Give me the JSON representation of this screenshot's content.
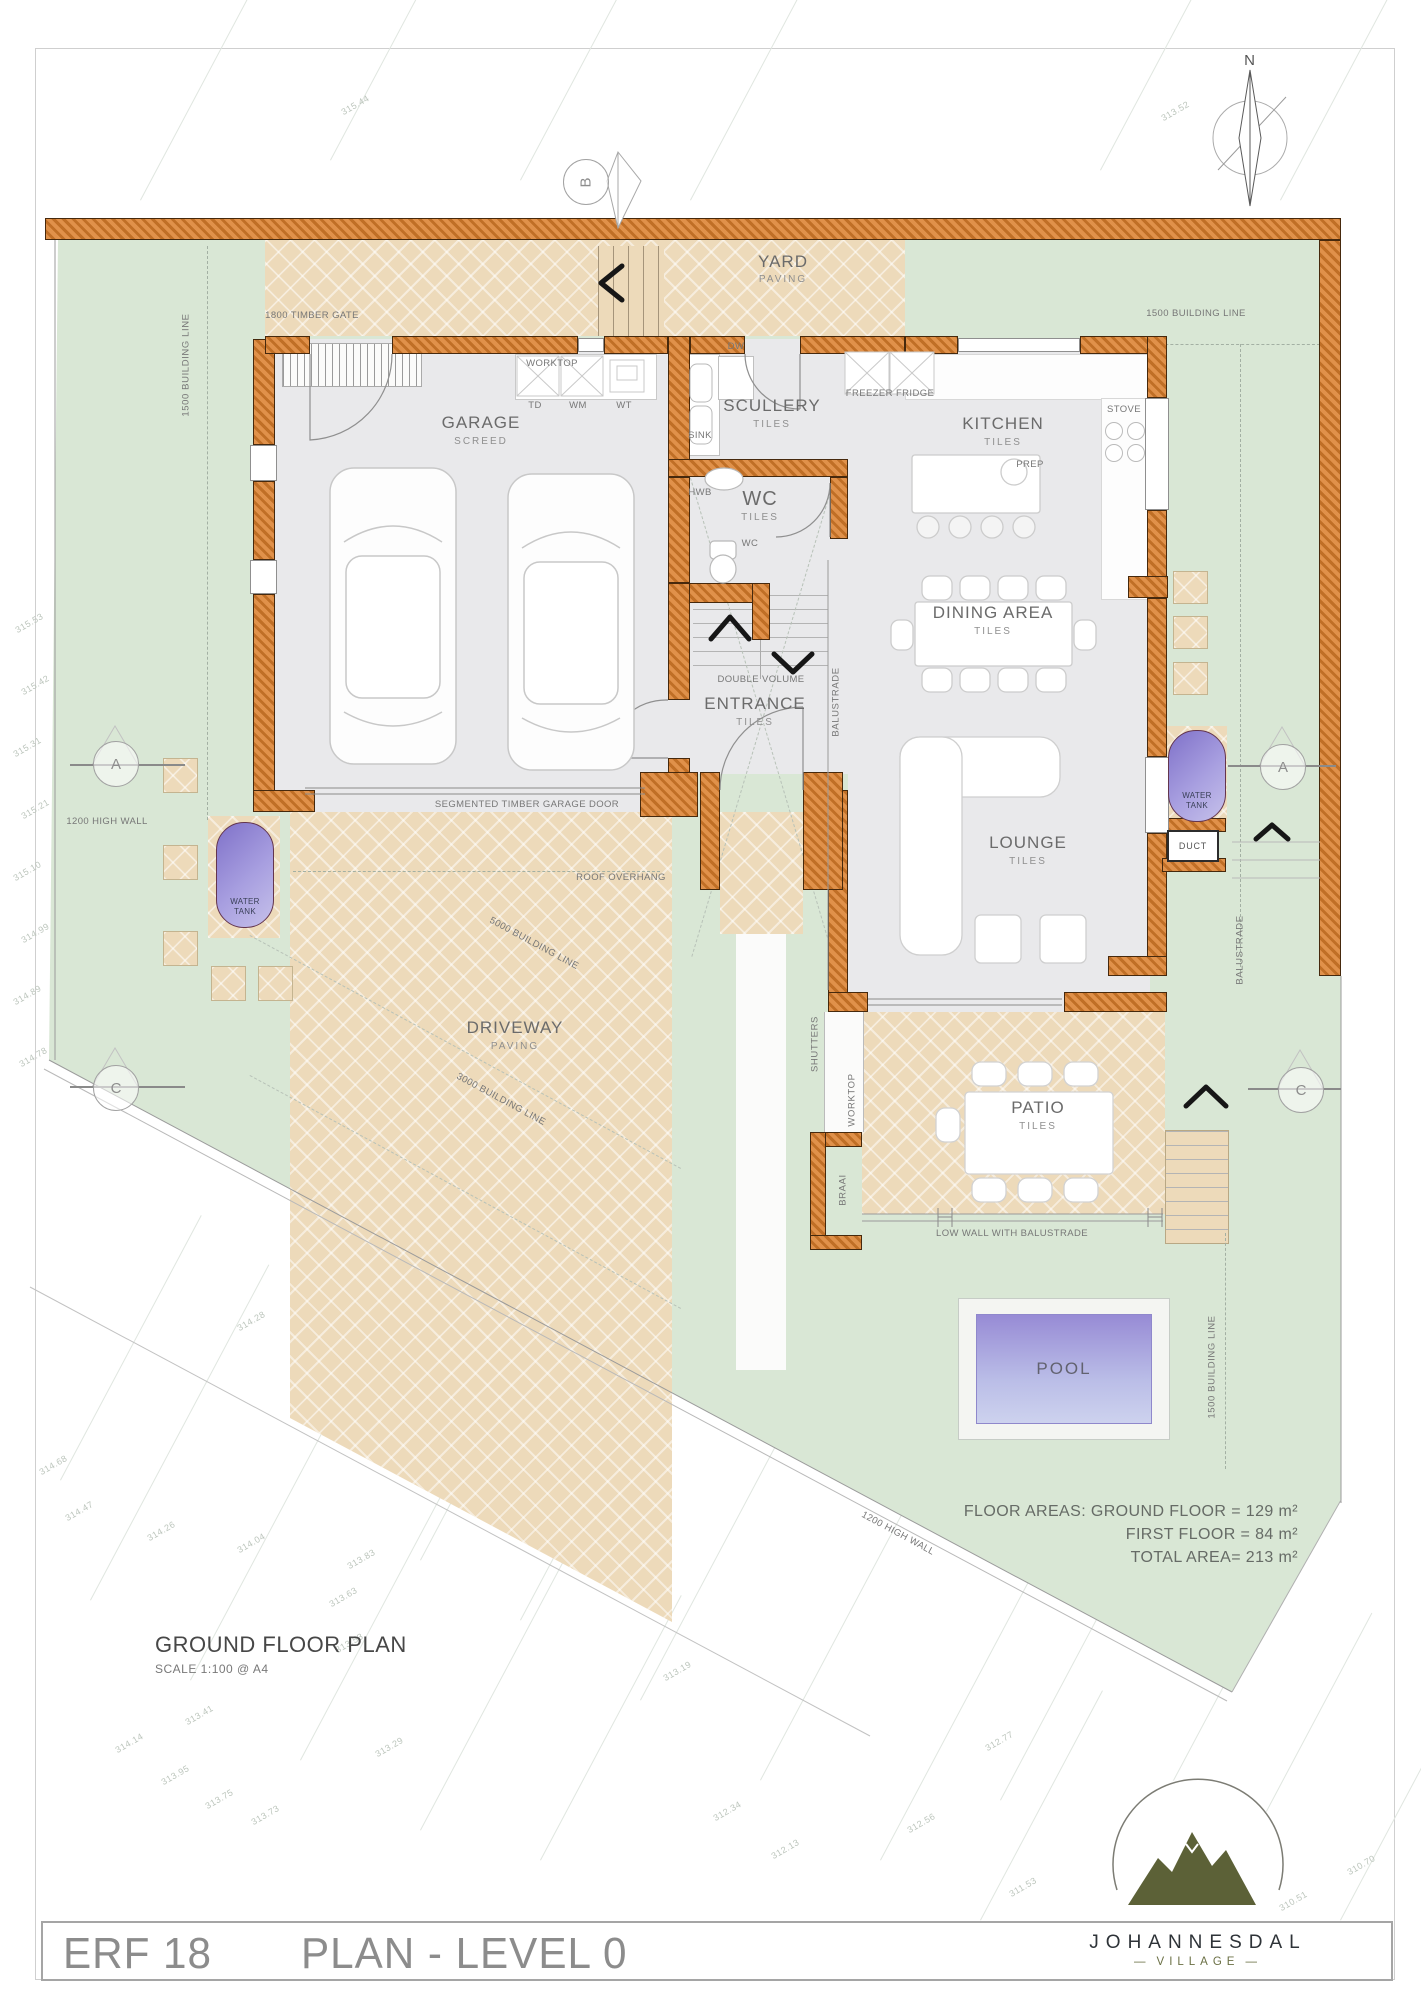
{
  "title_block": {
    "erf": "ERF 18",
    "plan_label": "PLAN - LEVEL 0"
  },
  "logo": {
    "name": "JOHANNESDAL",
    "subtitle": "VILLAGE"
  },
  "plan_heading": {
    "title": "GROUND FLOOR PLAN",
    "scale": "SCALE 1:100 @ A4"
  },
  "floor_areas": {
    "line1": "FLOOR AREAS: GROUND FLOOR = 129 m²",
    "line2": "FIRST FLOOR =   84 m²",
    "line3": "TOTAL AREA= 213 m²"
  },
  "rooms": {
    "yard": {
      "name": "YARD",
      "finish": "PAVING"
    },
    "garage": {
      "name": "GARAGE",
      "finish": "SCREED"
    },
    "scullery": {
      "name": "SCULLERY",
      "finish": "TILES"
    },
    "kitchen": {
      "name": "KITCHEN",
      "finish": "TILES"
    },
    "wc": {
      "name": "WC",
      "finish": "TILES"
    },
    "dining": {
      "name": "DINING AREA",
      "finish": "TILES"
    },
    "entrance": {
      "name": "ENTRANCE",
      "finish": "TILES"
    },
    "lounge": {
      "name": "LOUNGE",
      "finish": "TILES"
    },
    "patio": {
      "name": "PATIO",
      "finish": "TILES"
    },
    "driveway": {
      "name": "DRIVEWAY",
      "finish": "PAVING"
    },
    "pool": {
      "name": "POOL"
    }
  },
  "fixtures": {
    "worktop": "WORKTOP",
    "td": "TD",
    "wm": "WM",
    "wt": "WT",
    "dw": "DW",
    "sink": "SINK",
    "hwb": "HWB",
    "wc_pan": "WC",
    "freezer_fridge": "FREEZER  FRIDGE",
    "stove": "STOVE",
    "prep": "PREP",
    "braai": "BRAAI",
    "duct": "DUCT",
    "water_tank": "WATER TANK",
    "shutters": "SHUTTERS",
    "balustrade": "BALUSTRADE",
    "double_volume": "DOUBLE VOLUME"
  },
  "annotations": {
    "timber_gate": "1800 TIMBER GATE",
    "building_line_1500": "1500 BUILDING LINE",
    "building_line_5000": "5000 BUILDING LINE",
    "building_line_3000": "3000 BUILDING LINE",
    "high_wall_1200": "1200 HIGH WALL",
    "roof_overhang": "ROOF OVERHANG",
    "garage_door": "SEGMENTED TIMBER GARAGE DOOR",
    "low_wall": "LOW WALL WITH BALUSTRADE"
  },
  "markers": {
    "a": "A",
    "b": "B",
    "c": "C",
    "north": "N"
  },
  "colors": {
    "wall": "#d98a43",
    "paving": "#eddaba",
    "lawn": "#d9e7d5",
    "floor": "#e9e9eb",
    "pool_water": "#9a8fd8",
    "tank": "#8d80d2"
  },
  "contours": [
    [
      "315.44",
      340,
      100
    ],
    [
      "313.52",
      1160,
      106
    ],
    [
      "312.84",
      1098,
      258
    ],
    [
      "315.16",
      282,
      250
    ],
    [
      "313.04",
      1050,
      574
    ],
    [
      "315.53",
      14,
      618
    ],
    [
      "315.42",
      20,
      680
    ],
    [
      "315.31",
      12,
      742
    ],
    [
      "315.21",
      20,
      804
    ],
    [
      "315.10",
      12,
      866
    ],
    [
      "314.99",
      20,
      928
    ],
    [
      "314.89",
      12,
      990
    ],
    [
      "314.78",
      18,
      1052
    ],
    [
      "314.68",
      38,
      1460
    ],
    [
      "314.47",
      64,
      1506
    ],
    [
      "314.28",
      236,
      1316
    ],
    [
      "314.26",
      146,
      1526
    ],
    [
      "314.14",
      114,
      1738
    ],
    [
      "314.04",
      236,
      1538
    ],
    [
      "313.95",
      160,
      1770
    ],
    [
      "313.83",
      346,
      1554
    ],
    [
      "313.75",
      204,
      1794
    ],
    [
      "313.73",
      250,
      1810
    ],
    [
      "313.63",
      328,
      1592
    ],
    [
      "313.53",
      334,
      1638
    ],
    [
      "313.41",
      184,
      1710
    ],
    [
      "313.29",
      374,
      1742
    ],
    [
      "313.19",
      662,
      1666
    ],
    [
      "312.77",
      984,
      1736
    ],
    [
      "312.56",
      906,
      1818
    ],
    [
      "312.34",
      712,
      1806
    ],
    [
      "312.13",
      770,
      1844
    ],
    [
      "311.91",
      1120,
      1846
    ],
    [
      "311.74",
      1158,
      1876
    ],
    [
      "311.53",
      1008,
      1882
    ],
    [
      "310.95",
      1236,
      1842
    ],
    [
      "310.70",
      1346,
      1860
    ],
    [
      "310.51",
      1278,
      1896
    ]
  ]
}
